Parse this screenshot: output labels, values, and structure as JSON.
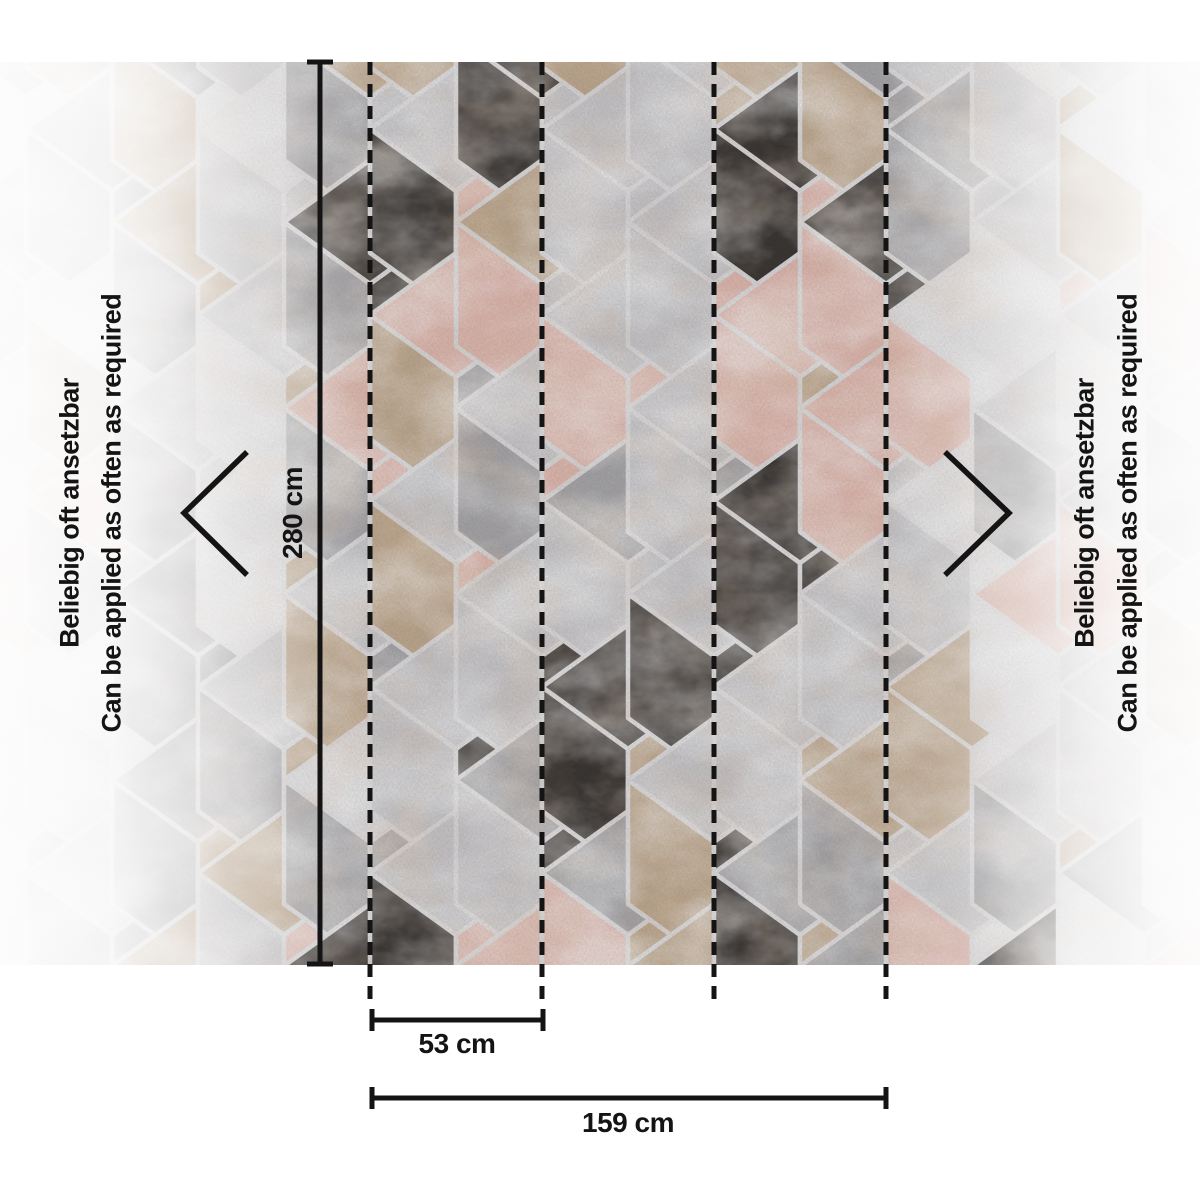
{
  "dimensions": {
    "height_label": "280 cm",
    "repeat_label": "53 cm",
    "width_label": "159 cm"
  },
  "side_note": {
    "de": "Beliebig oft ansetzbar",
    "en": "Can be applied as often as required"
  },
  "palette": {
    "K": "#322e2b",
    "P": "#e2b9af",
    "B": "#c0a98e",
    "L": "#cac9cc",
    "G": "#a6a5a8",
    "W": "#dfdee0",
    "grout": "#dcdbdd",
    "line": "#141414",
    "vein_white": "#ffffff",
    "vein_copper": "#b98a63",
    "background": "#ffffff"
  },
  "pattern": {
    "hex_width": 172,
    "hex_radius": 124,
    "col_step": 86,
    "row_step": 186,
    "origin_x": 370,
    "even_cy_start": 98,
    "odd_cy_start": 5,
    "top": 62,
    "bottom": 965,
    "cubes": {
      "0,0": "BGL",
      "0,1": "KGK",
      "0,2": "PGP",
      "0,3": "LBG",
      "0,4": "WGG",
      "0,5": "KLL",
      "1,0": "LBL",
      "1,1": "LKP",
      "1,2": "PBG",
      "1,3": "LBP",
      "1,4": "LLK",
      "1,5": "LKP",
      "2,0": "KKL",
      "2,1": "BPL",
      "2,2": "LGP",
      "2,3": "LLK",
      "2,4": "GLK",
      "2,5": "PPP",
      "3,0": "LBB",
      "3,1": "LLL",
      "3,2": "LPP",
      "3,3": "GLL",
      "3,4": "KKB",
      "3,5": "GPB",
      "4,0": "LLB",
      "4,1": "LLP",
      "4,2": "LLG",
      "4,3": "LKK",
      "4,4": "LBK",
      "4,5": "BBK",
      "5,0": "LBB",
      "5,1": "KKP",
      "5,2": "PPB",
      "5,3": "KKK",
      "5,4": "LLB",
      "5,5": "GKB",
      "6,0": "GBG",
      "6,1": "KPK",
      "6,2": "PPL",
      "6,3": "LLG",
      "6,4": "BGL",
      "6,5": "GLL",
      "7,0": "LLW",
      "7,1": "GGL",
      "7,2": "WPW",
      "7,3": "WLW",
      "7,4": "BBW",
      "7,5": "LPW"
    },
    "outside_weights": "LLLLLGGGWWWBBPPK"
  },
  "guides": {
    "dashed_x": [
      370,
      542,
      714,
      886
    ],
    "dashed_top": 62,
    "dashed_bottom": 1003,
    "height_line_x": 320,
    "repeat_line": {
      "x1": 372,
      "x2": 543,
      "y": 1020
    },
    "width_line": {
      "x1": 372,
      "x2": 886,
      "y": 1098
    },
    "chevron_left": [
      [
        247,
        452
      ],
      [
        184,
        513
      ],
      [
        247,
        575
      ]
    ],
    "chevron_right": [
      [
        945,
        452
      ],
      [
        1009,
        513
      ],
      [
        945,
        575
      ]
    ]
  }
}
